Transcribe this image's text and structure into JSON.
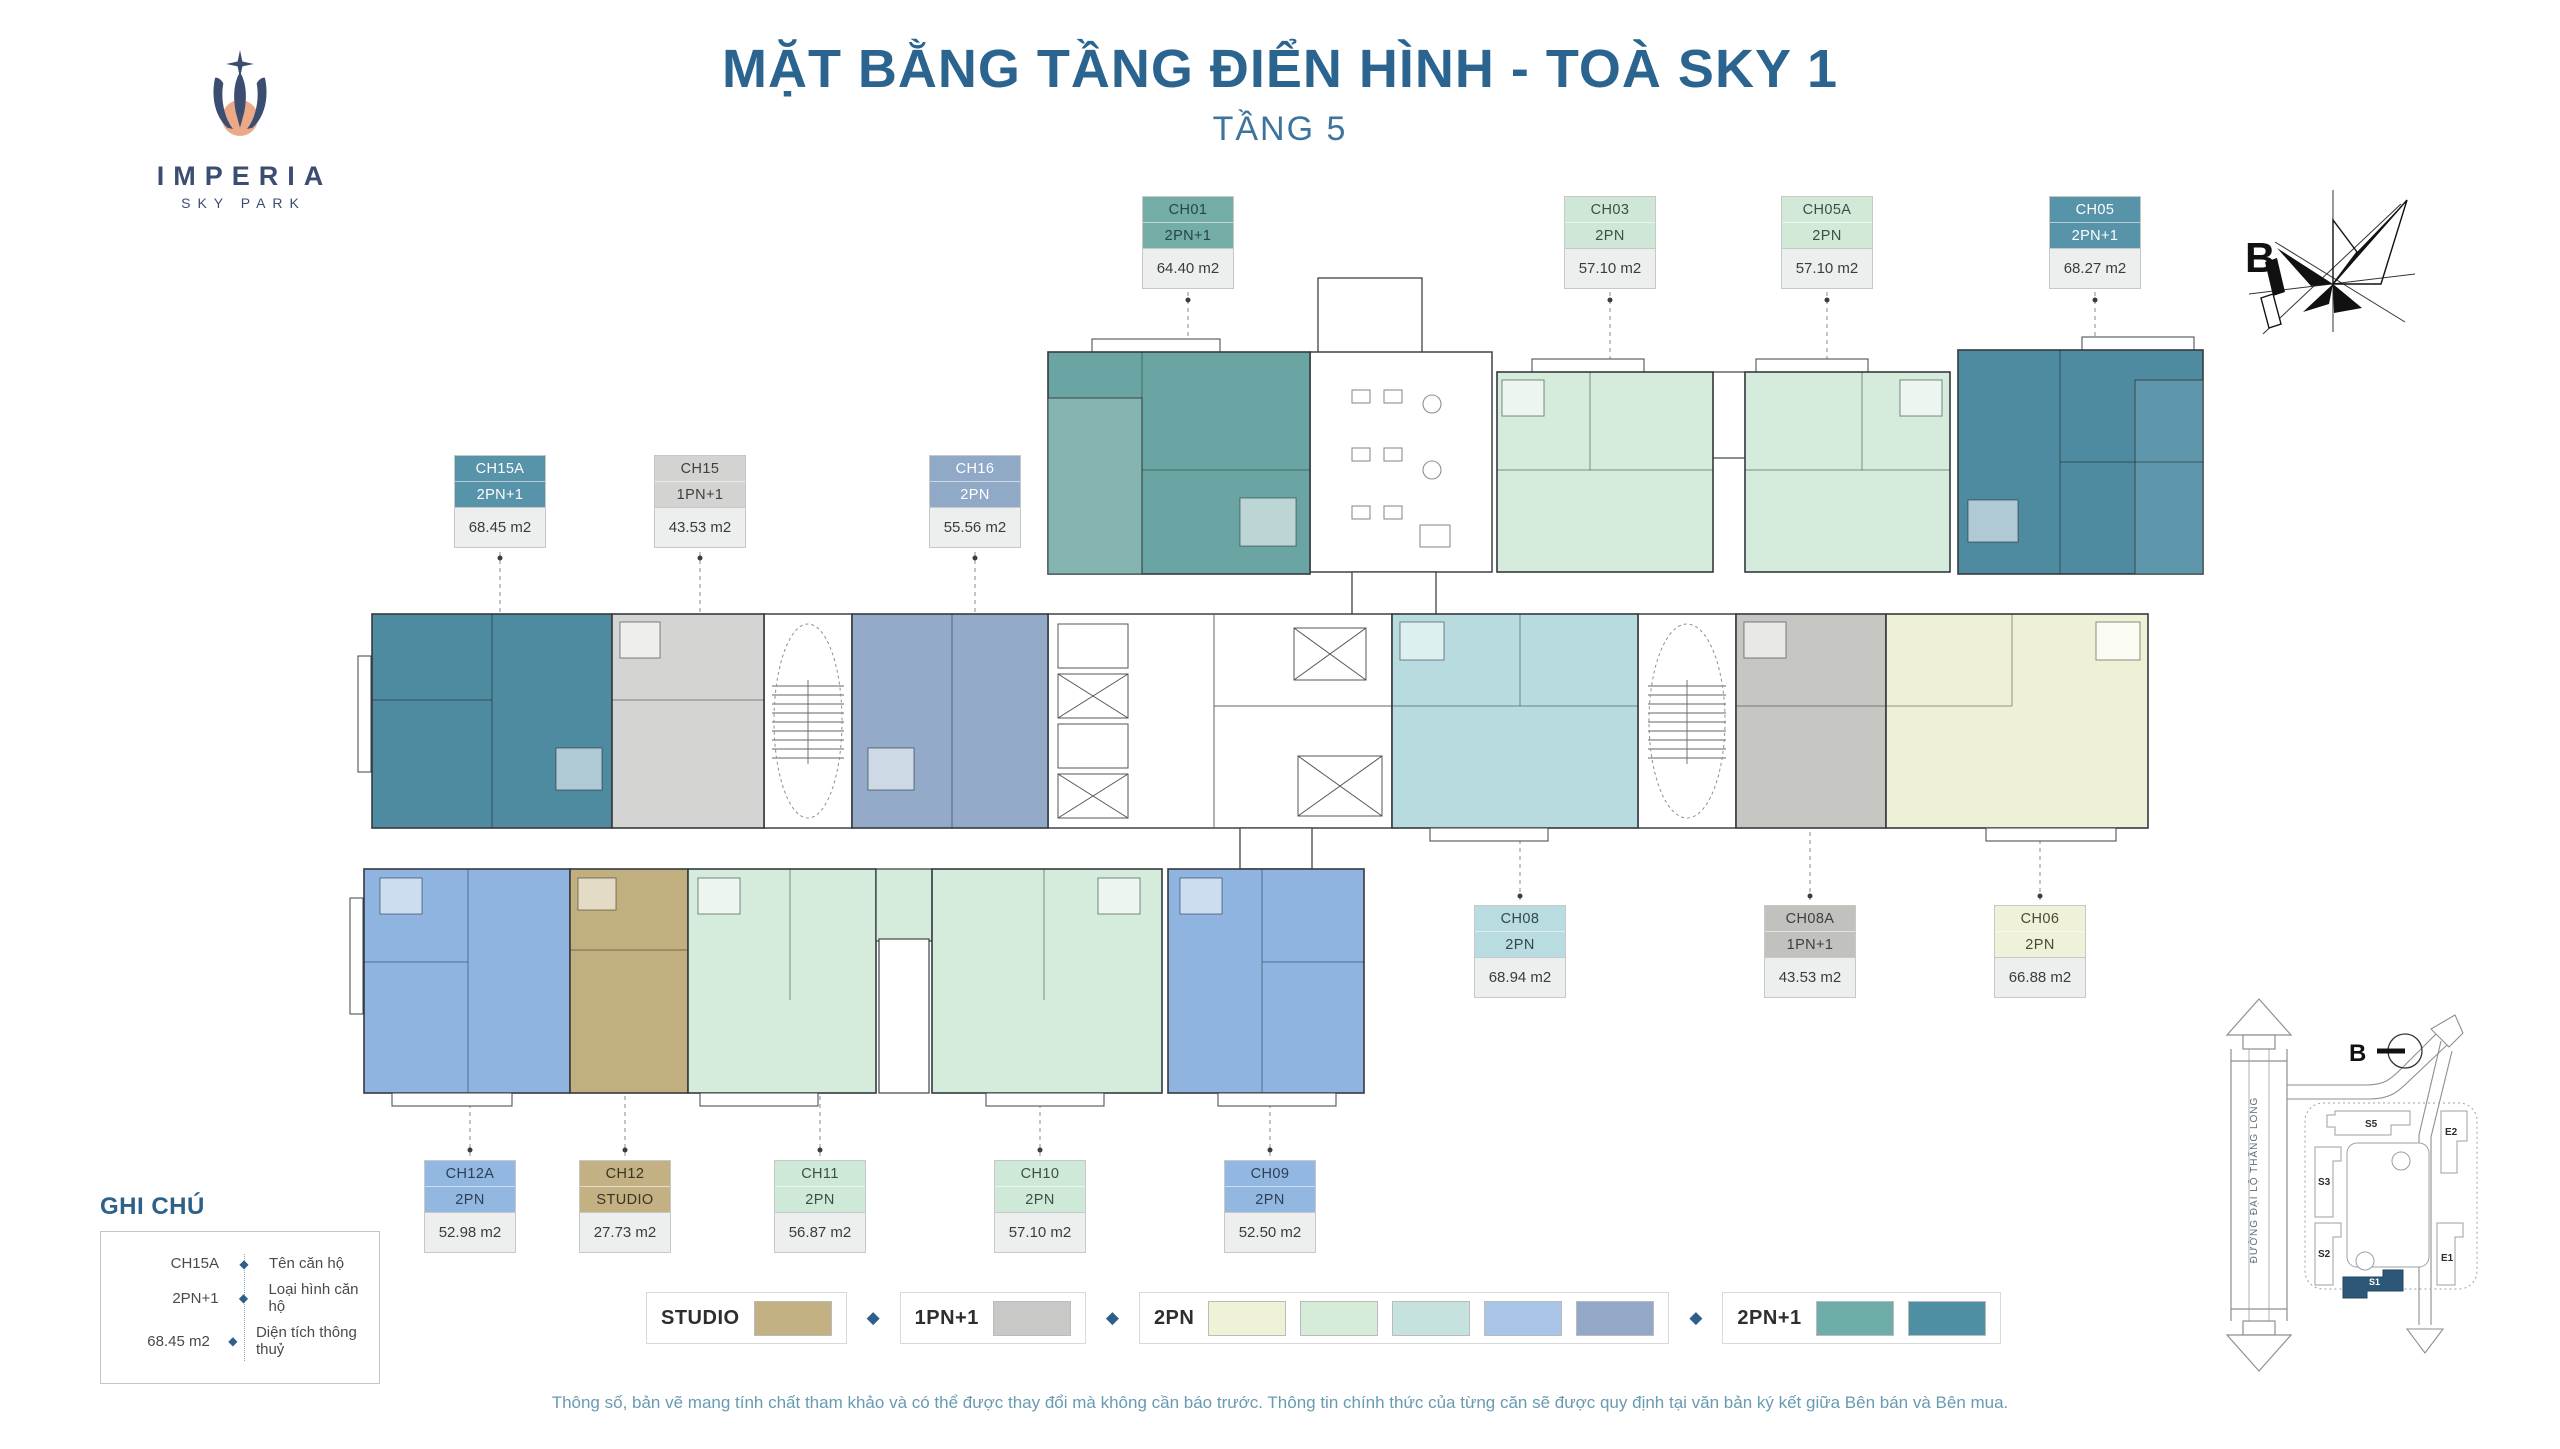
{
  "header": {
    "logo": {
      "brand": "IMPERIA",
      "sub_brand": "SKY PARK"
    },
    "title": "MẶT BẰNG TẦNG ĐIỂN HÌNH - TOÀ SKY 1",
    "subtitle": "TẦNG 5"
  },
  "units": [
    {
      "code": "CH01",
      "type": "2PN+1",
      "area": "64.40 m2",
      "color_bg": "#74aca6",
      "color_fg": "#25454c"
    },
    {
      "code": "CH03",
      "type": "2PN",
      "area": "57.10 m2",
      "color_bg": "#cfe7d6",
      "color_fg": "#3c4f45"
    },
    {
      "code": "CH05A",
      "type": "2PN",
      "area": "57.10 m2",
      "color_bg": "#d2e9d8",
      "color_fg": "#3c4f45"
    },
    {
      "code": "CH05",
      "type": "2PN+1",
      "area": "68.27 m2",
      "color_bg": "#5793a9",
      "color_fg": "#ffffff"
    },
    {
      "code": "CH15A",
      "type": "2PN+1",
      "area": "68.45 m2",
      "color_bg": "#5793a9",
      "color_fg": "#ffffff"
    },
    {
      "code": "CH15",
      "type": "1PN+1",
      "area": "43.53 m2",
      "color_bg": "#d3d3d1",
      "color_fg": "#3f3f3f"
    },
    {
      "code": "CH16",
      "type": "2PN",
      "area": "55.56 m2",
      "color_bg": "#8fa9c7",
      "color_fg": "#ffffff"
    },
    {
      "code": "CH08",
      "type": "2PN",
      "area": "68.94 m2",
      "color_bg": "#b8dce0",
      "color_fg": "#33474d"
    },
    {
      "code": "CH08A",
      "type": "1PN+1",
      "area": "43.53 m2",
      "color_bg": "#c1c1bd",
      "color_fg": "#3f3f3f"
    },
    {
      "code": "CH06",
      "type": "2PN",
      "area": "66.88 m2",
      "color_bg": "#eff1d8",
      "color_fg": "#4a4a38"
    },
    {
      "code": "CH12A",
      "type": "2PN",
      "area": "52.98 m2",
      "color_bg": "#92b7e0",
      "color_fg": "#2e3f54"
    },
    {
      "code": "CH12",
      "type": "STUDIO",
      "area": "27.73 m2",
      "color_bg": "#c3b183",
      "color_fg": "#3a3424"
    },
    {
      "code": "CH11",
      "type": "2PN",
      "area": "56.87 m2",
      "color_bg": "#cfe9d8",
      "color_fg": "#3c4f45"
    },
    {
      "code": "CH10",
      "type": "2PN",
      "area": "57.10 m2",
      "color_bg": "#cfe9d8",
      "color_fg": "#3c4f45"
    },
    {
      "code": "CH09",
      "type": "2PN",
      "area": "52.50 m2",
      "color_bg": "#92b7e0",
      "color_fg": "#2e3f54"
    }
  ],
  "legend_note": {
    "title": "GHI CHÚ",
    "diamond": "◆",
    "rows": [
      {
        "key": "CH15A",
        "label": "Tên căn hộ"
      },
      {
        "key": "2PN+1",
        "label": "Loại hình căn hộ"
      },
      {
        "key": "68.45 m2",
        "label": "Diện tích thông thuỷ"
      }
    ]
  },
  "color_legend": {
    "separator": "◆",
    "separator_color": "#2d5f8a",
    "groups": [
      {
        "label": "STUDIO",
        "colors": [
          "#c3b183"
        ]
      },
      {
        "label": "1PN+1",
        "colors": [
          "#c8c8c6"
        ]
      },
      {
        "label": "2PN",
        "colors": [
          "#f0f2d8",
          "#d6ecd9",
          "#c5e2de",
          "#a9c6e8",
          "#93a7c6"
        ]
      },
      {
        "label": "2PN+1",
        "colors": [
          "#6fada8",
          "#4f8fa4"
        ]
      }
    ]
  },
  "compass": {
    "label": "B"
  },
  "site_map": {
    "road_label": "ĐƯỜNG ĐẠI LỘ THĂNG LONG",
    "buildings": [
      "S5",
      "E2",
      "S3",
      "S2",
      "E1"
    ],
    "highlighted_building": "S1",
    "highlight_color": "#2d5777",
    "compass_label": "B"
  },
  "disclaimer": "Thông số, bản vẽ mang tính chất tham khảo và có thể được thay đổi mà không cần báo trước. Thông tin chính thức của từng căn sẽ được quy định tại văn bản ký kết giữa Bên bán và Bên mua.",
  "colors": {
    "title_blue": "#2a648f",
    "brand_navy": "#3c4d72",
    "logo_peach": "#eba987",
    "plan_teal": "#6aa5a3",
    "plan_dark_teal": "#4e8ba0",
    "plan_green": "#d5ebdb",
    "plan_cyan": "#b7dbde",
    "plan_gray": "#d4d4d2",
    "plan_blue_gray": "#93aac8",
    "plan_blue": "#8fb4df",
    "plan_tan": "#c1af80",
    "plan_pale_yellow": "#eff1d7"
  }
}
